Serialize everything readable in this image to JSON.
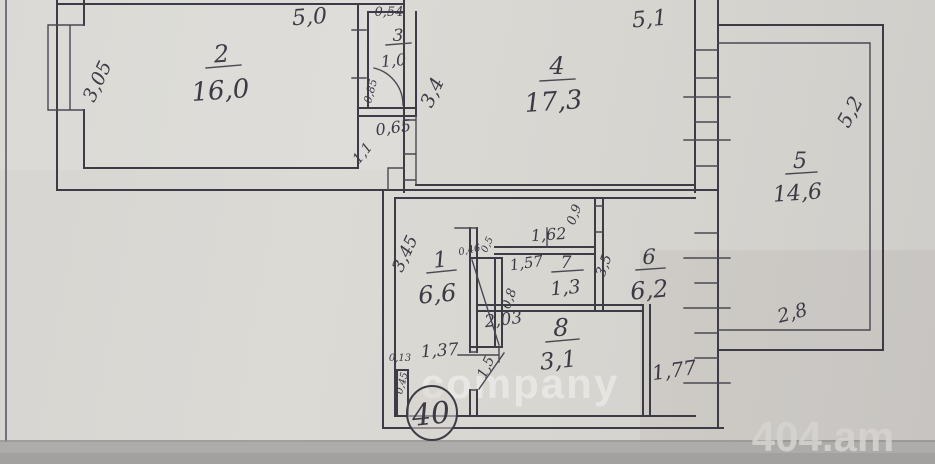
{
  "document": {
    "type": "apartment floor plan (scanned hand-drawn BTI sketch)",
    "apartment_badge": "40"
  },
  "rooms": [
    {
      "number": "1",
      "area": "6,6"
    },
    {
      "number": "2",
      "area": "16,0"
    },
    {
      "number": "3",
      "area": "1,0"
    },
    {
      "number": "4",
      "area": "17,3"
    },
    {
      "number": "5",
      "area": "14,6"
    },
    {
      "number": "6",
      "area": "6,2"
    },
    {
      "number": "7",
      "area": "1,3"
    },
    {
      "number": "8",
      "area": "3,1"
    }
  ],
  "dims": {
    "room2_width": "5,0",
    "room2_depth": "3,05",
    "room3_width": "0,54",
    "room3_door": "0,85",
    "passage_width": "0,65",
    "passage_diag": "1,1",
    "room4_depth": "3,4",
    "room4_width": "5,1",
    "room5_depth": "5,2",
    "room5_width": "2,8",
    "room1_depth": "3,45",
    "closet_width": "0,46",
    "closet_depth": "0,5",
    "lobby_width": "1,62",
    "room7_width": "1,57",
    "room7_depth": "0,8",
    "door_room6": "0,9",
    "room6_depth": "3,5",
    "hall_width": "2,03",
    "bath_width": "1,37",
    "jamb_width": "0,13",
    "jamb_depth": "0,45",
    "door_room8": "1,5",
    "entry_width": "1,77"
  },
  "watermarks": {
    "center": "company",
    "corner": "404.am"
  },
  "colors": {
    "ink": "#3c3b46",
    "paper": "#d7d5d1",
    "bottom_strip": "#aeacaa"
  }
}
